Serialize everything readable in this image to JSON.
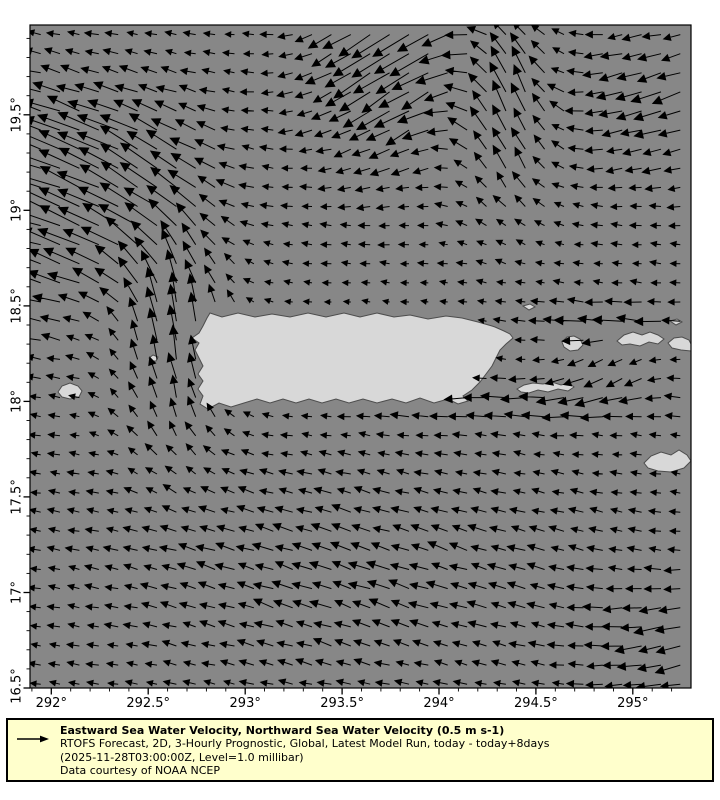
{
  "map": {
    "background_color": "#ffffff",
    "sea_color": "#878787",
    "land_color": "#d8d8d8",
    "coast_color": "#4d4d4d",
    "frame_color": "#000000",
    "box_px": {
      "left": 30,
      "top": 25,
      "width": 661,
      "height": 663
    },
    "lon_min": 291.89,
    "lon_max": 295.3,
    "lat_min": 16.5,
    "lat_max": 19.97
  },
  "axes": {
    "tick_color": "#000000",
    "label_font_px": 13,
    "minor_step": 0.1,
    "x_major": [
      {
        "value": 292.0,
        "label": "292°"
      },
      {
        "value": 292.5,
        "label": "292.5°"
      },
      {
        "value": 293.0,
        "label": "293°"
      },
      {
        "value": 293.5,
        "label": "293.5°"
      },
      {
        "value": 294.0,
        "label": "294°"
      },
      {
        "value": 294.5,
        "label": "294.5°"
      },
      {
        "value": 295.0,
        "label": "295°"
      }
    ],
    "y_major": [
      {
        "value": 16.5,
        "label": "16.5°"
      },
      {
        "value": 17.0,
        "label": "17°"
      },
      {
        "value": 17.5,
        "label": "17.5°"
      },
      {
        "value": 18.0,
        "label": "18°"
      },
      {
        "value": 18.5,
        "label": "18.5°"
      },
      {
        "value": 19.0,
        "label": "19°"
      },
      {
        "value": 19.5,
        "label": "19.5°"
      }
    ]
  },
  "quiver": {
    "arrow_color": "#000000",
    "reference_speed_m_s": 0.5,
    "px_per_speed_unit": 58,
    "grid": {
      "lon_start": 291.945,
      "lon_step": 0.1,
      "cols": 34,
      "lat_start": 19.92,
      "lat_step": 0.1,
      "rows": 35
    },
    "base_flow": {
      "u": -0.17,
      "v": 0.02
    },
    "features": [
      {
        "name": "mona-passage-north-jet",
        "lon": 292.65,
        "lat": 18.35,
        "slon": 0.28,
        "slat": 0.55,
        "amp": 0.62,
        "dir": 82
      },
      {
        "name": "northwest-outflow",
        "lon": 292.35,
        "lat": 19.15,
        "slon": 0.45,
        "slat": 0.45,
        "amp": 0.7,
        "dir": 148
      },
      {
        "name": "west-edge-flow",
        "lon": 291.95,
        "lat": 19.0,
        "slon": 0.3,
        "slat": 0.6,
        "amp": 0.45,
        "dir": 162
      },
      {
        "name": "top-front-southwest-flow",
        "lon": 293.8,
        "lat": 19.8,
        "slon": 0.42,
        "slat": 0.5,
        "amp": 0.65,
        "dir": 225
      },
      {
        "name": "north-column",
        "lon": 294.35,
        "lat": 19.55,
        "slon": 0.26,
        "slat": 0.5,
        "amp": 0.55,
        "dir": 92
      },
      {
        "name": "top-right-southwest-flow",
        "lon": 295.15,
        "lat": 19.6,
        "slon": 0.4,
        "slat": 0.4,
        "amp": 0.33,
        "dir": 212
      },
      {
        "name": "south-coast-west-jet",
        "lon": 294.3,
        "lat": 18.0,
        "slon": 0.8,
        "slat": 0.13,
        "amp": 0.4,
        "dir": 183
      },
      {
        "name": "virgin-islands-west-jet",
        "lon": 294.9,
        "lat": 18.4,
        "slon": 0.45,
        "slat": 0.11,
        "amp": 0.36,
        "dir": 178
      },
      {
        "name": "vieques-sound-south-flow",
        "lon": 294.85,
        "lat": 18.15,
        "slon": 0.25,
        "slat": 0.15,
        "amp": 0.22,
        "dir": 250
      },
      {
        "name": "south-basin-drift",
        "lon": 293.6,
        "lat": 17.1,
        "slon": 1.2,
        "slat": 0.55,
        "amp": 0.2,
        "dir": 150
      },
      {
        "name": "bottom-right-flow",
        "lon": 295.2,
        "lat": 16.7,
        "slon": 0.4,
        "slat": 0.35,
        "amp": 0.28,
        "dir": 205
      }
    ],
    "coastal_damp": {
      "lon": 293.65,
      "lat": 18.22,
      "slon": 0.9,
      "slat": 0.4,
      "strength": 0.5
    },
    "jitter": {
      "angle_deg": 12,
      "mag": 0.3
    }
  },
  "islands": [
    {
      "name": "puerto-rico",
      "points": [
        [
          210,
          313
        ],
        [
          222,
          317
        ],
        [
          238,
          313
        ],
        [
          255,
          317
        ],
        [
          272,
          314
        ],
        [
          290,
          317
        ],
        [
          308,
          313
        ],
        [
          326,
          317
        ],
        [
          344,
          313
        ],
        [
          360,
          317
        ],
        [
          377,
          313
        ],
        [
          394,
          317
        ],
        [
          410,
          315
        ],
        [
          428,
          319
        ],
        [
          446,
          316
        ],
        [
          462,
          318
        ],
        [
          478,
          322
        ],
        [
          492,
          326
        ],
        [
          495,
          327
        ],
        [
          504,
          331
        ],
        [
          510,
          334
        ],
        [
          513,
          338
        ],
        [
          506,
          344
        ],
        [
          500,
          350
        ],
        [
          496,
          358
        ],
        [
          492,
          366
        ],
        [
          486,
          374
        ],
        [
          480,
          382
        ],
        [
          472,
          390
        ],
        [
          463,
          396
        ],
        [
          468,
          401
        ],
        [
          458,
          404
        ],
        [
          448,
          399
        ],
        [
          434,
          403
        ],
        [
          420,
          398
        ],
        [
          406,
          403
        ],
        [
          392,
          399
        ],
        [
          377,
          403
        ],
        [
          363,
          399
        ],
        [
          349,
          403
        ],
        [
          336,
          399
        ],
        [
          322,
          403
        ],
        [
          309,
          399
        ],
        [
          296,
          403
        ],
        [
          283,
          399
        ],
        [
          270,
          403
        ],
        [
          257,
          399
        ],
        [
          244,
          403
        ],
        [
          231,
          407
        ],
        [
          219,
          403
        ],
        [
          208,
          409
        ],
        [
          200,
          404
        ],
        [
          203,
          396
        ],
        [
          198,
          389
        ],
        [
          203,
          381
        ],
        [
          198,
          374
        ],
        [
          203,
          366
        ],
        [
          199,
          358
        ],
        [
          195,
          350
        ],
        [
          199,
          343
        ],
        [
          192,
          338
        ],
        [
          199,
          333
        ],
        [
          203,
          326
        ],
        [
          207,
          318
        ]
      ]
    },
    {
      "name": "vieques",
      "points": [
        [
          517,
          389
        ],
        [
          524,
          385
        ],
        [
          533,
          383
        ],
        [
          543,
          384
        ],
        [
          552,
          382
        ],
        [
          561,
          385
        ],
        [
          569,
          383
        ],
        [
          574,
          387
        ],
        [
          568,
          391
        ],
        [
          558,
          389
        ],
        [
          548,
          392
        ],
        [
          538,
          390
        ],
        [
          529,
          393
        ],
        [
          521,
          392
        ]
      ]
    },
    {
      "name": "culebra",
      "points": [
        [
          562,
          342
        ],
        [
          567,
          337
        ],
        [
          574,
          336
        ],
        [
          580,
          339
        ],
        [
          583,
          345
        ],
        [
          578,
          350
        ],
        [
          570,
          351
        ],
        [
          564,
          347
        ]
      ]
    },
    {
      "name": "st-thomas",
      "points": [
        [
          617,
          341
        ],
        [
          624,
          335
        ],
        [
          633,
          332
        ],
        [
          642,
          335
        ],
        [
          650,
          332
        ],
        [
          658,
          335
        ],
        [
          664,
          339
        ],
        [
          658,
          344
        ],
        [
          649,
          342
        ],
        [
          640,
          346
        ],
        [
          630,
          344
        ],
        [
          622,
          345
        ]
      ]
    },
    {
      "name": "st-john",
      "points": [
        [
          668,
          343
        ],
        [
          674,
          338
        ],
        [
          682,
          337
        ],
        [
          689,
          340
        ],
        [
          691,
          344
        ],
        [
          691,
          351
        ],
        [
          681,
          350
        ],
        [
          672,
          348
        ]
      ]
    },
    {
      "name": "st-croix",
      "points": [
        [
          644,
          463
        ],
        [
          651,
          456
        ],
        [
          661,
          452
        ],
        [
          671,
          455
        ],
        [
          679,
          450
        ],
        [
          687,
          455
        ],
        [
          691,
          461
        ],
        [
          684,
          468
        ],
        [
          671,
          472
        ],
        [
          658,
          471
        ],
        [
          648,
          468
        ]
      ]
    },
    {
      "name": "mona",
      "points": [
        [
          58,
          392
        ],
        [
          62,
          386
        ],
        [
          70,
          383
        ],
        [
          78,
          386
        ],
        [
          82,
          391
        ],
        [
          79,
          397
        ],
        [
          70,
          399
        ],
        [
          62,
          397
        ]
      ]
    },
    {
      "name": "desecheo",
      "points": [
        [
          149,
          358
        ],
        [
          153,
          355
        ],
        [
          158,
          357
        ],
        [
          156,
          361
        ],
        [
          151,
          361
        ]
      ]
    },
    {
      "name": "islet-northeast",
      "points": [
        [
          523,
          306
        ],
        [
          530,
          304
        ],
        [
          535,
          307
        ],
        [
          529,
          310
        ]
      ]
    },
    {
      "name": "islet-east",
      "points": [
        [
          670,
          321
        ],
        [
          677,
          319
        ],
        [
          682,
          322
        ],
        [
          676,
          325
        ]
      ]
    }
  ],
  "legend": {
    "bg_color": "#ffffcc",
    "border_color": "#000000",
    "box_px": {
      "left": 6,
      "top": 718,
      "width": 708,
      "height": 64
    },
    "line1": "Eastward Sea Water Velocity, Northward Sea Water Velocity (0.5 m s-1)",
    "line2": "RTOFS Forecast, 2D, 3-Hourly Prognostic, Global, Latest Model Run, today - today+8days",
    "line3": "(2025-11-28T03:00:00Z, Level=1.0 millibar)",
    "line4": "Data courtesy of NOAA NCEP"
  }
}
